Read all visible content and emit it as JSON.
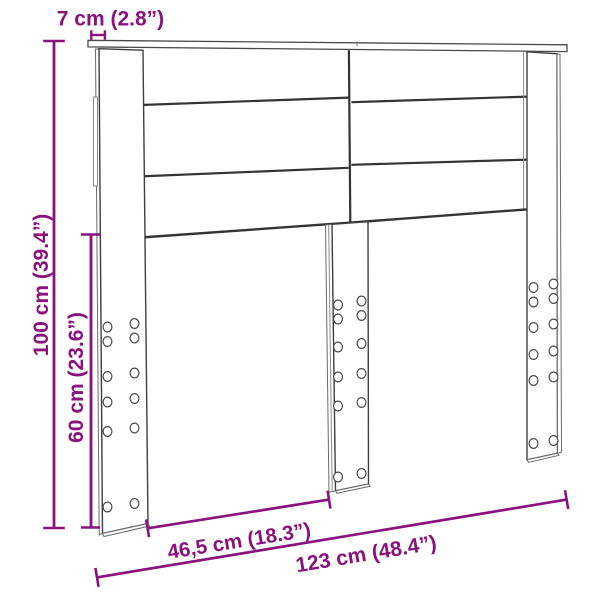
{
  "diagram": {
    "kind": "furniture-dimension-diagram",
    "subject": "headboard-with-legs",
    "background_color": "#ffffff",
    "accent_color": "#8A127D",
    "outline_color": "#3f3f3f"
  },
  "labels": {
    "depth": "7 cm (2.8”)",
    "height_total": "100 cm (39.4”)",
    "height_legs": "60 cm (23.6”)",
    "width_inner": "46,5 cm (18.3”)",
    "width_total": "123 cm (48.4”)"
  }
}
